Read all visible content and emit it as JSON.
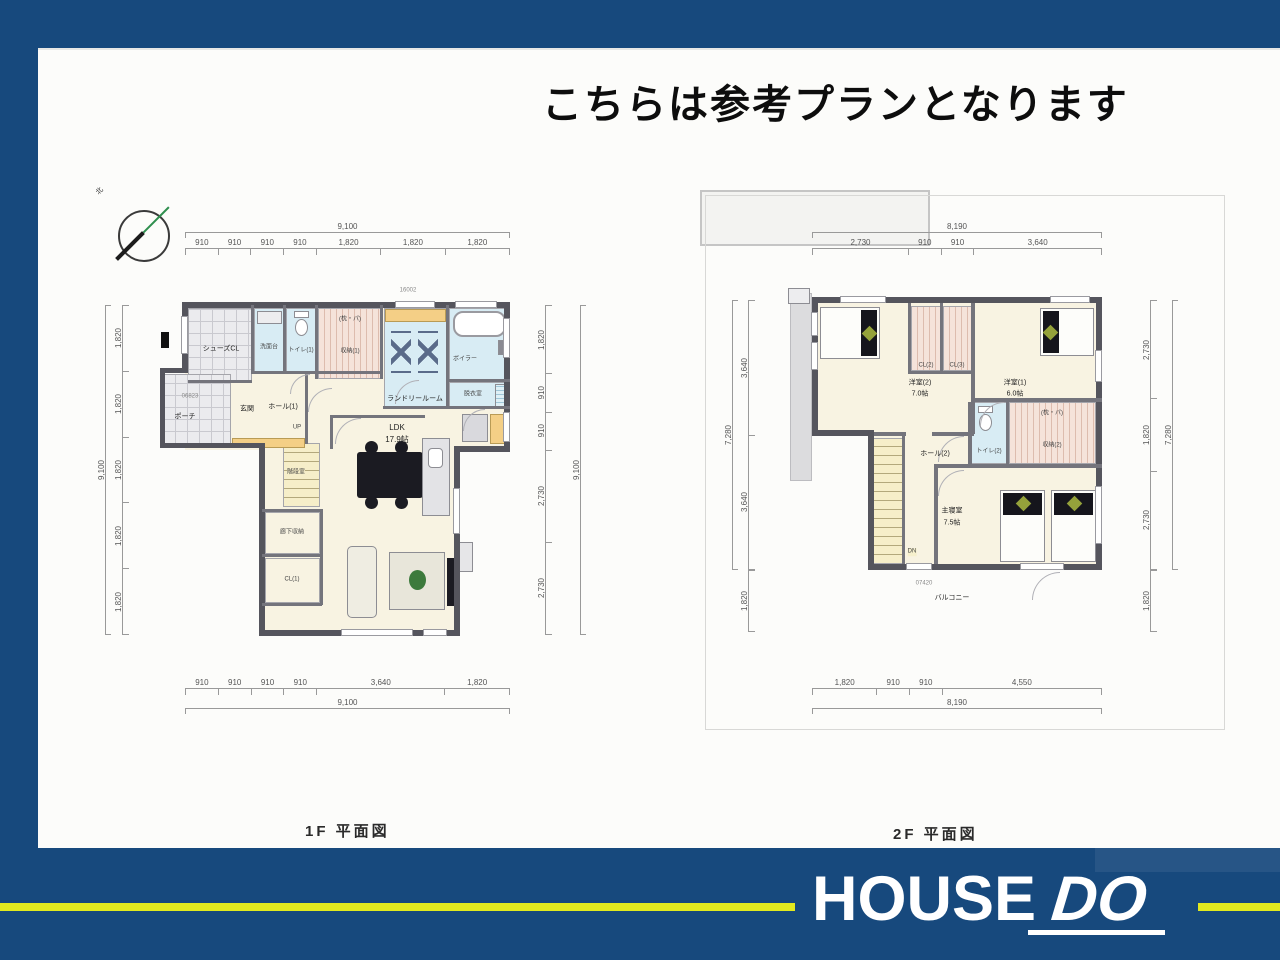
{
  "title": "こちらは参考プランとなります",
  "footer": {
    "logo_house": "HOUSE",
    "logo_do": "DO"
  },
  "f1": {
    "caption": "1F 平面図",
    "compass": "北",
    "codes": {
      "top_sash": "16002",
      "porch_sash": "06823"
    },
    "dims": {
      "top_total": "9,100",
      "top": [
        "910",
        "910",
        "910",
        "910",
        "1,820",
        "1,820",
        "1,820"
      ],
      "bottom": [
        "910",
        "910",
        "910",
        "910",
        "3,640",
        "1,820"
      ],
      "bottom_total": "9,100",
      "left_total": "9,100",
      "left": [
        "1,820",
        "1,820",
        "1,820",
        "1,820",
        "1,820"
      ],
      "right": [
        "1,820",
        "910",
        "910",
        "2,730",
        "2,730"
      ],
      "right_total": "9,100"
    },
    "rooms": {
      "shoes_cl": "シューズCL",
      "porch": "ポーチ",
      "genkan": "玄関",
      "hall1": "ホール(1)",
      "washstand": "洗面台",
      "toilet1": "トイレ(1)",
      "storage1_note": "(枕・パ)",
      "storage1": "収納(1)",
      "laundry": "ランドリールーム",
      "boiler": "ボイラー",
      "datsui": "脱衣室",
      "stair": "階段室",
      "up": "UP",
      "hall_storage": "廊下収納",
      "cl1": "CL(1)",
      "ldk_name": "LDK",
      "ldk_size": "17.9帖"
    }
  },
  "f2": {
    "caption": "2F 平面図",
    "codes": {
      "balcony_sash": "07420"
    },
    "dims": {
      "top_total": "8,190",
      "top": [
        "2,730",
        "910",
        "910",
        "3,640"
      ],
      "bottom": [
        "1,820",
        "910",
        "910",
        "4,550"
      ],
      "bottom_total": "8,190",
      "left_total": "7,280",
      "left": [
        "3,640",
        "3,640"
      ],
      "left_balcony": "1,820",
      "right_total": "7,280",
      "right": [
        "2,730",
        "1,820",
        "2,730"
      ],
      "right_balcony": "1,820"
    },
    "rooms": {
      "yoshitsu2_name": "洋室(2)",
      "yoshitsu2_size": "7.0帖",
      "cl2": "CL(2)",
      "cl3": "CL(3)",
      "yoshitsu1_name": "洋室(1)",
      "yoshitsu1_size": "6.0帖",
      "hall2": "ホール(2)",
      "toilet2": "トイレ(2)",
      "storage2_note": "(枕・パ)",
      "storage2": "収納(2)",
      "shinshitsu_name": "主寝室",
      "shinshitsu_size": "7.5帖",
      "dn": "DN",
      "balcony": "バルコニー"
    }
  }
}
